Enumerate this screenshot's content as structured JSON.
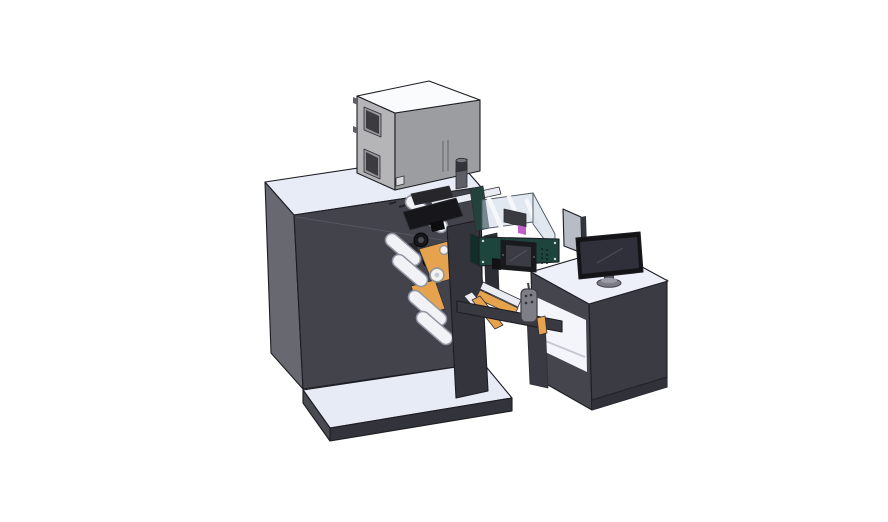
{
  "scene": {
    "type": "3d-cad-isometric-render",
    "subject": "Industrial label printing / converting machine with unwind rollers, print head, transparent conveyor enclosure, HMI control box and operator desk with monitor",
    "background": "#ffffff"
  },
  "colors": {
    "background": "#ffffff",
    "machine_top": "#e8ecf6",
    "machine_side": "#686871",
    "machine_front": "#43434c",
    "plate_top": "#e7ebf5",
    "plate_front": "#33333b",
    "plate_side": "#4a4a53",
    "cabinet_top": "#fafbfd",
    "cabinet_left": "#b5b5b7",
    "cabinet_right": "#9c9da0",
    "window_frame": "#95959a",
    "window_glass": "#3b3b40",
    "corner_plate": "#d9dbde",
    "hinge": "#5f5f66",
    "cylinder": "#5e5e66",
    "cylinder_cap": "#33333a",
    "cylinder_top": "#74747c",
    "rail_light": "#e9ecf3",
    "head_dark": "#17171b",
    "head_mid": "#26262b",
    "head_black": "#0d0d10",
    "gear_hub": "#4c4c55",
    "orange": "#e6a24c",
    "roller_white": "#f0f2f6",
    "roller_edge": "#8f95a1",
    "roller_hub": "#c7cbd4",
    "column": "#34343d",
    "stand_bar": "#2d2d35",
    "desk_top": "#edf0f8",
    "desk_front": "#3b3b44",
    "desk_side": "#45454e",
    "desk_interior": "#f3f5fa",
    "desk_kick": "#31313a",
    "desk_leg": "#3a3a42",
    "enclosure_wall": "rgba(198,209,224,0.5)",
    "enclosure_rail": "#f5f7fa",
    "enclosure_block": "#3a3a41",
    "magenta": "#c05fc9",
    "green_front": "#1d453e",
    "green_side": "#112e28",
    "green_end_wall": "#24423c",
    "screen_bezel": "#191a1d",
    "screen_face": "#3b3b44",
    "screw_light": "#cfd8d2",
    "vent_dot": "#0c2420",
    "connector": "#121215",
    "beam_dark": "#393941",
    "pendant": "#7e7e87",
    "pendant_button": "#2f2f36",
    "panel_light": "#b7bcc5",
    "panel_edge": "#35353d",
    "monitor_bezel": "#141417",
    "monitor_screen": "#30303a",
    "monitor_neck": "#5a5a64",
    "monitor_base": "#7b7b85",
    "monitor_base_top": "#9b9ba5"
  },
  "parts": [
    "main machine cabinet",
    "electrical cabinet (top)",
    "exhaust cylinder",
    "print head assembly",
    "unwind and rewind rollers",
    "orange web guide plates",
    "roller stand column",
    "machine base plate",
    "web path strips",
    "transparent conveyor enclosure",
    "HMI control box with touchscreen",
    "pendant remote",
    "bridge beam",
    "operator desk",
    "desktop monitor",
    "divider panel"
  ]
}
